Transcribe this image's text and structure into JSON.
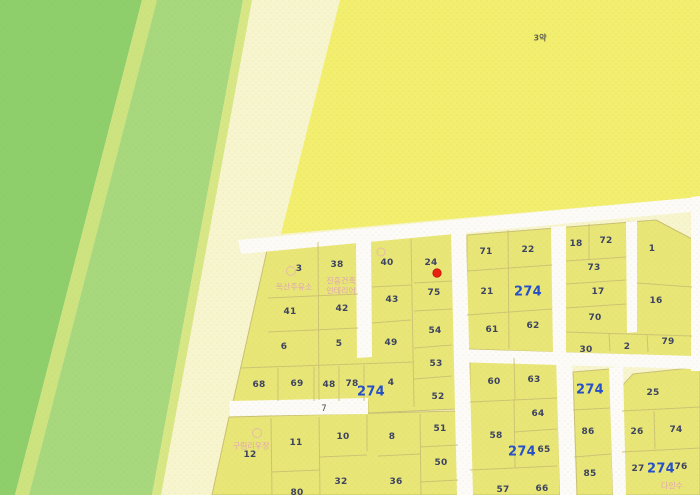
{
  "map": {
    "field_label": "3약",
    "road_label": "7",
    "pois": {
      "gas_station": "옥산주유소",
      "interior_line1": "진흥건축",
      "interior_line2": "인테리어",
      "village": "구림리우정",
      "southeast": "다인수"
    },
    "parcels": {
      "a3": "3",
      "a38": "38",
      "a41": "41",
      "a42": "42",
      "a6": "6",
      "a5": "5",
      "a68": "68",
      "a69": "69",
      "a48": "48",
      "a78": "78",
      "b40": "40",
      "b24": "24",
      "b43": "43",
      "b75": "75",
      "b49": "49",
      "b54": "54",
      "b53": "53",
      "b4": "4",
      "b274": "274",
      "b52": "52",
      "c71": "71",
      "c22": "22",
      "c21": "21",
      "c274": "274",
      "c61": "61",
      "c62": "62",
      "d18": "18",
      "d72": "72",
      "d1": "1",
      "d73": "73",
      "d17": "17",
      "d16": "16",
      "d70": "70",
      "d30": "30",
      "d2": "2",
      "d79": "79",
      "e12": "12",
      "e11": "11",
      "e80": "80",
      "f10": "10",
      "f8": "8",
      "f32": "32",
      "f36": "36",
      "f51": "51",
      "f50": "50",
      "g60": "60",
      "g63": "63",
      "g64": "64",
      "g58": "58",
      "g274": "274",
      "g65": "65",
      "g57": "57",
      "g66": "66",
      "h274": "274",
      "h86": "86",
      "h85": "85",
      "i25": "25",
      "i26": "26",
      "i74": "74",
      "i27": "27",
      "i274": "274",
      "i76": "76"
    },
    "colors": {
      "forest_green": "#8ecf6c",
      "light_green": "#a7d87d",
      "green_stripe": "#cde37f",
      "cream_band": "#f7f5cd",
      "field_yellow": "#f2ee6e",
      "parcel_fill": "#e9e678",
      "boundary_line": "#c9c173",
      "road_white": "#fcfbf7",
      "parcel_number": "#3d4460",
      "block_number_blue": "#2550c8",
      "marker_red": "#ea2110",
      "poi_pink": "#df9fba"
    }
  }
}
